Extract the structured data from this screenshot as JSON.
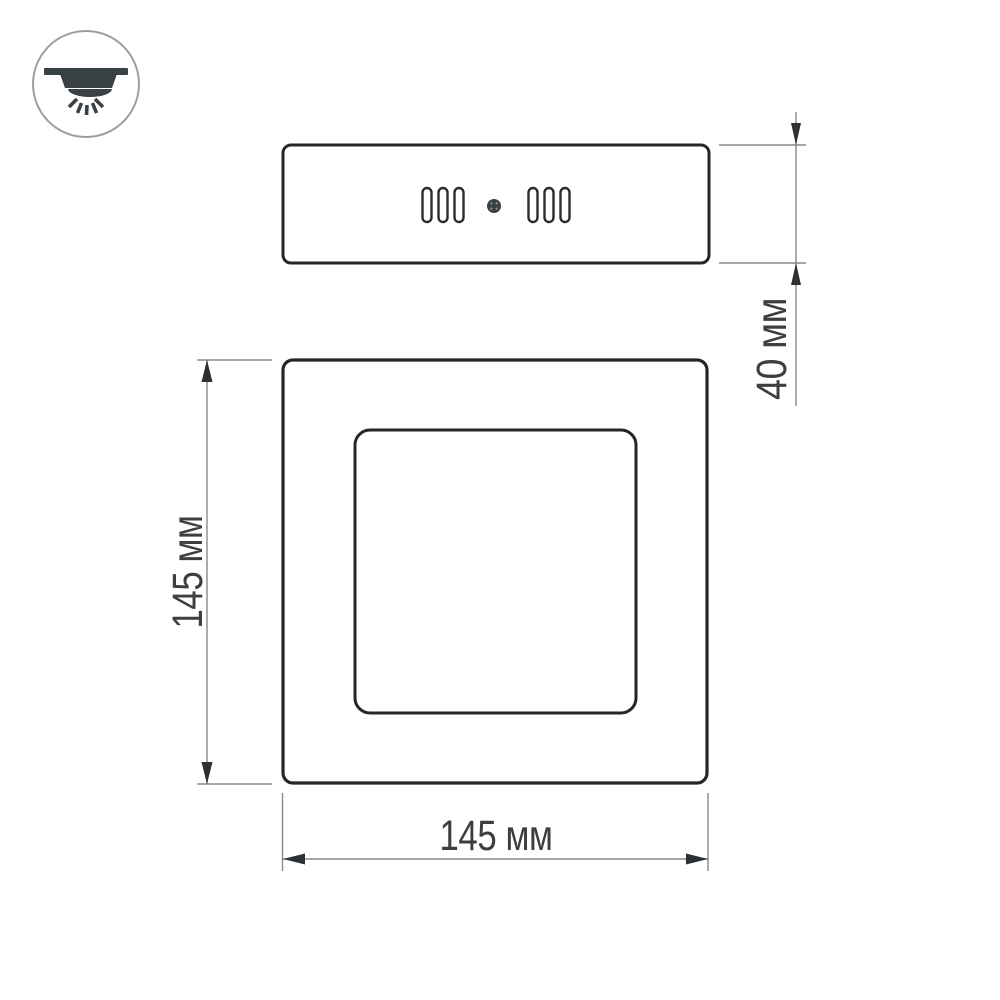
{
  "drawing": {
    "kind": "technical-dimension-drawing",
    "icon": {
      "name": "ceiling-downlight-icon"
    },
    "dimensions": {
      "width": {
        "label": "145 мм",
        "value": 145,
        "unit": "мм"
      },
      "height": {
        "label": "145 мм",
        "value": 145,
        "unit": "мм"
      },
      "depth": {
        "label": "40 мм",
        "value": 40,
        "unit": "мм"
      }
    },
    "colors": {
      "background": "#ffffff",
      "outline": "#242729",
      "dimension_line": "#85898b",
      "arrowhead": "#2d3134",
      "dimension_text": "#3b3f42",
      "icon_stroke": "#9aa0a2",
      "icon_fill": "#3a4144"
    }
  }
}
